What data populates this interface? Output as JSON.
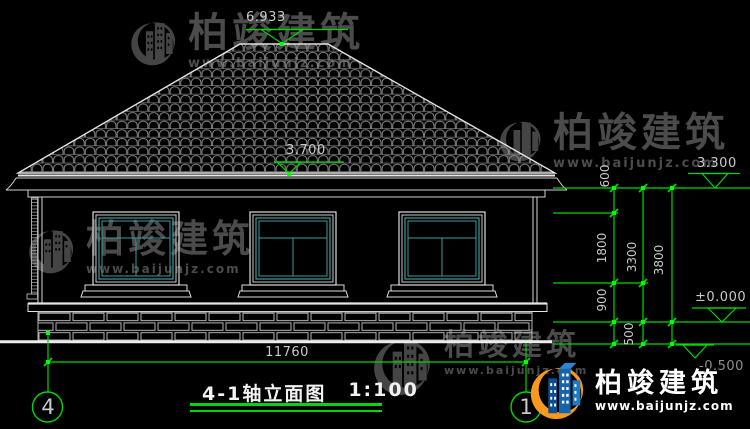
{
  "drawing": {
    "title": "4-1轴立面图",
    "scale": "1:100",
    "axis_left": "4",
    "axis_right": "1",
    "levels": {
      "ridge": "6.933",
      "roof_eave": "3.700",
      "cornice_top": "3.300",
      "ground_zero": "±0.000",
      "below_ground": "-0.500"
    },
    "dims": {
      "total_width": "11760",
      "d600": "600",
      "d1800": "1800",
      "d3300": "3300",
      "d3800": "3800",
      "d900": "900",
      "d500": "500"
    }
  },
  "watermark": {
    "brand": "柏竣建筑",
    "url": "www.baijunjz.com"
  },
  "logo": {
    "brand": "柏竣建筑",
    "url": "www.baijunjz.com"
  },
  "colors": {
    "background": "#000000",
    "line": "#d9d9d9",
    "dimension_green": "#00d800",
    "window_glass": "#3f9d9e",
    "watermark_gray": "#4b4b4b",
    "logo_blue": "#1565ad",
    "logo_orange": "#f6991e"
  }
}
